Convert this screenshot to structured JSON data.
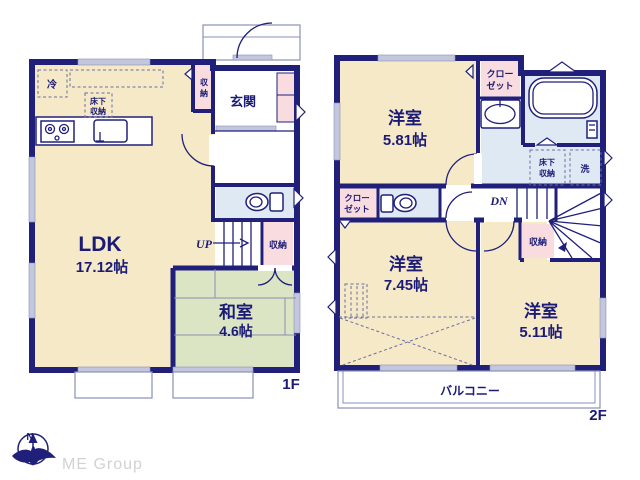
{
  "f1": {
    "floor_label": "1F",
    "ldk_name": "LDK",
    "ldk_size": "17.12帖",
    "washitsu_name": "和室",
    "washitsu_size": "4.6帖",
    "genkan": "玄関",
    "fridge": "冷",
    "underfloor_1": "床下",
    "underfloor_2": "収納",
    "hall_storage_1": "収",
    "hall_storage_2": "納",
    "stairs_up": "UP",
    "stairs_storage": "収納"
  },
  "f2": {
    "floor_label": "2F",
    "room1_name": "洋室",
    "room1_size": "5.81帖",
    "room2_name": "洋室",
    "room2_size": "7.45帖",
    "room3_name": "洋室",
    "room3_size": "5.11帖",
    "closet_a_1": "クロー",
    "closet_a_2": "ゼット",
    "closet_b_1": "クロー",
    "closet_b_2": "ゼット",
    "underfloor_1": "床下",
    "underfloor_2": "収納",
    "laundry": "洗",
    "stairs_down": "DN",
    "storage": "収納",
    "balcony": "バルコニー"
  },
  "logo": {
    "compass_n": "N",
    "company": "ME Group"
  },
  "colors": {
    "wall": "#20207b",
    "room_cream": "#f6e9c8",
    "room_tatami": "#dbe5c3",
    "room_pink": "#f9dce0",
    "room_blue": "#dfe9f4",
    "window_gray": "#c3c6dc"
  }
}
